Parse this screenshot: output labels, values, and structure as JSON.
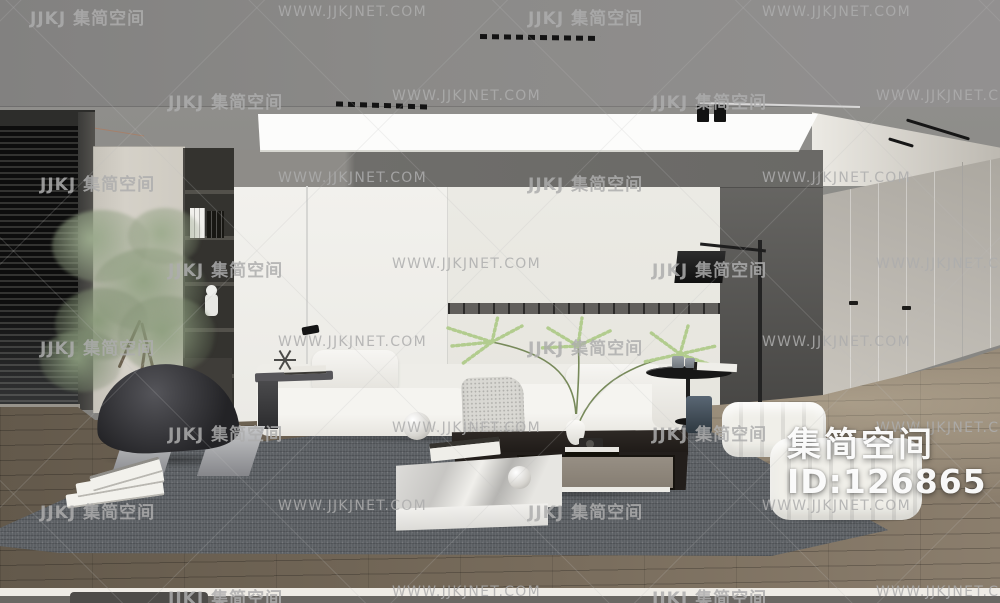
{
  "page": {
    "width": 1000,
    "height": 603,
    "description": "3D interior render of a modern minimalist living room"
  },
  "watermark": {
    "brand_text": "JJKJ 集简空间",
    "url_text": "WWW.JJKJNET.COM",
    "color": "#adadad",
    "rows": [
      {
        "y": 4,
        "items": [
          {
            "x": 30,
            "t": "brand"
          },
          {
            "x": 278,
            "t": "url"
          },
          {
            "x": 528,
            "t": "brand"
          },
          {
            "x": 762,
            "t": "url"
          }
        ]
      },
      {
        "y": 88,
        "items": [
          {
            "x": 168,
            "t": "brand"
          },
          {
            "x": 392,
            "t": "url"
          },
          {
            "x": 652,
            "t": "brand"
          },
          {
            "x": 876,
            "t": "url"
          }
        ]
      },
      {
        "y": 170,
        "items": [
          {
            "x": 40,
            "t": "brand"
          },
          {
            "x": 278,
            "t": "url"
          },
          {
            "x": 528,
            "t": "brand"
          },
          {
            "x": 762,
            "t": "url"
          }
        ]
      },
      {
        "y": 256,
        "items": [
          {
            "x": 168,
            "t": "brand"
          },
          {
            "x": 392,
            "t": "url"
          },
          {
            "x": 652,
            "t": "brand"
          },
          {
            "x": 876,
            "t": "url"
          }
        ]
      },
      {
        "y": 334,
        "items": [
          {
            "x": 40,
            "t": "brand"
          },
          {
            "x": 278,
            "t": "url"
          },
          {
            "x": 528,
            "t": "brand"
          },
          {
            "x": 762,
            "t": "url"
          }
        ]
      },
      {
        "y": 420,
        "items": [
          {
            "x": 168,
            "t": "brand"
          },
          {
            "x": 392,
            "t": "url"
          },
          {
            "x": 652,
            "t": "brand"
          },
          {
            "x": 876,
            "t": "url"
          }
        ]
      },
      {
        "y": 498,
        "items": [
          {
            "x": 40,
            "t": "brand"
          },
          {
            "x": 278,
            "t": "url"
          },
          {
            "x": 528,
            "t": "brand"
          },
          {
            "x": 762,
            "t": "url"
          }
        ]
      },
      {
        "y": 584,
        "items": [
          {
            "x": 168,
            "t": "brand"
          },
          {
            "x": 392,
            "t": "url"
          },
          {
            "x": 652,
            "t": "brand"
          },
          {
            "x": 876,
            "t": "url"
          }
        ]
      }
    ]
  },
  "badge": {
    "title": "集简空间",
    "id": "ID:126865"
  },
  "scene": {
    "palette": {
      "ceiling": "#8b8a88",
      "far_wall": "#8d8b88",
      "feature_band": "#6f6e6b",
      "wall_panel": "#f1f0ec",
      "dark_side_wall": "#555451",
      "wardrobe": "#b8b4ad",
      "wood_floor": "#786c5c",
      "rug": "#5c6064",
      "sofa": "#f3f2ee",
      "chair": "#2a2a2d",
      "coffee_table": "#221e1b",
      "drawer_front": "#8f877c",
      "marble": "#e8e7e3",
      "plant_green": "#8fa181",
      "frond_green": "#b2cc8e",
      "blue_vase": "#46525d",
      "led_panel": "#fcfcfb",
      "blinds": "#141414"
    },
    "objects": [
      "window-blinds",
      "tall-cabinet",
      "bookshelf",
      "astronaut-figurine",
      "indoor-tree",
      "led-panel-light",
      "track-lights",
      "ceiling-spotlights",
      "white-panel-wall",
      "modular-sofa",
      "throw-blanket",
      "back-cushions",
      "lounge-chair",
      "magazine-stack",
      "reading-floor-lamp",
      "black-arc-floor-lamp",
      "coffee-table",
      "marble-platform",
      "decor-spheres",
      "table-plant",
      "white-vase",
      "camera-decor",
      "round-side-table",
      "glass-cups",
      "blue-cylinder-vase",
      "tufted-ottoman-small",
      "tufted-ottoman-large",
      "gray-area-rug",
      "wood-plank-floor",
      "wardrobe-doors"
    ]
  }
}
